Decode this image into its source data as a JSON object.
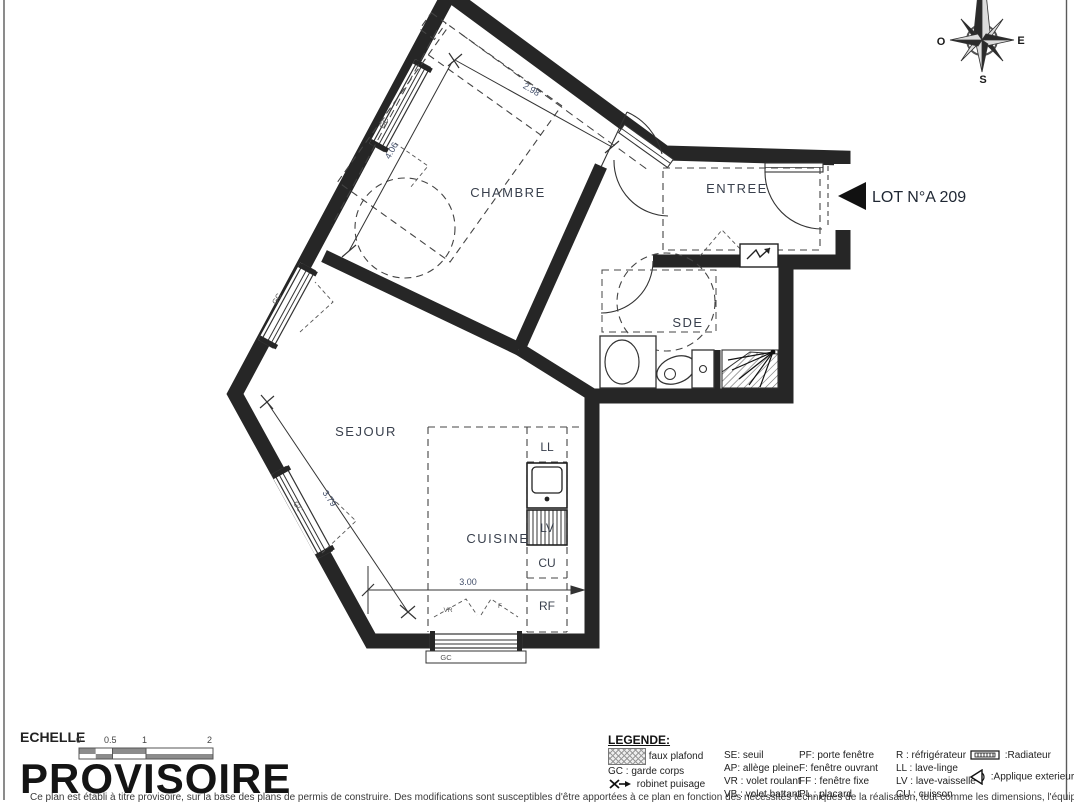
{
  "page": {
    "lot_label": "LOT N°A 209",
    "provisional_stamp": "PROVISOIRE",
    "disclaimer": "Ce plan est établi à titre provisoire, sur la base des plans de permis de construire. Des modifications sont susceptibles d'être apportées à ce plan en fonction des nécessités techniques de la réalisation, tout comme les dimensions, l'équipement, les surfaces et les prestations."
  },
  "compass": {
    "west": "O",
    "east": "E",
    "south": "S"
  },
  "rooms": {
    "chambre": "CHAMBRE",
    "entree": "ENTREE",
    "sde": "SDE",
    "sejour": "SEJOUR",
    "cuisine": "CUISINE"
  },
  "dimensions": {
    "top": "2.98",
    "left": "4.06",
    "lower_left": "3.79",
    "bottom": "3.00"
  },
  "kitchen": {
    "ll": "LL",
    "lv": "LV",
    "cu": "CU",
    "rf": "RF"
  },
  "window_labels": {
    "gc": "GC",
    "f": "F",
    "vr": "VR"
  },
  "scale": {
    "label": "ECHELLE",
    "ticks": [
      "0",
      "0.5",
      "1",
      "2"
    ]
  },
  "legend": {
    "title": "LEGENDE:",
    "col1": [
      {
        "icon": "faux-plafond-swatch",
        "label": "faux plafond"
      },
      {
        "label": "GC : garde corps"
      },
      {
        "icon": "robinet-puisage-icon",
        "label": "robinet puisage"
      }
    ],
    "col2": [
      "SE: seuil",
      "AP: allège pleine",
      "VR : volet roulant",
      "VB : volet battant"
    ],
    "col3": [
      "PF: porte fenêtre",
      "F: fenêtre ouvrant",
      "FF : fenêtre fixe",
      "PL : placard"
    ],
    "col4": [
      "R : réfrigérateur",
      "LL : lave-linge",
      "LV : lave-vaisselle",
      "CU : cuisson"
    ],
    "col5": [
      {
        "icon": "radiator-icon",
        "label": ":Radiateur"
      },
      {
        "icon": "applique-icon",
        "label": ":Applique exterieure"
      }
    ]
  }
}
